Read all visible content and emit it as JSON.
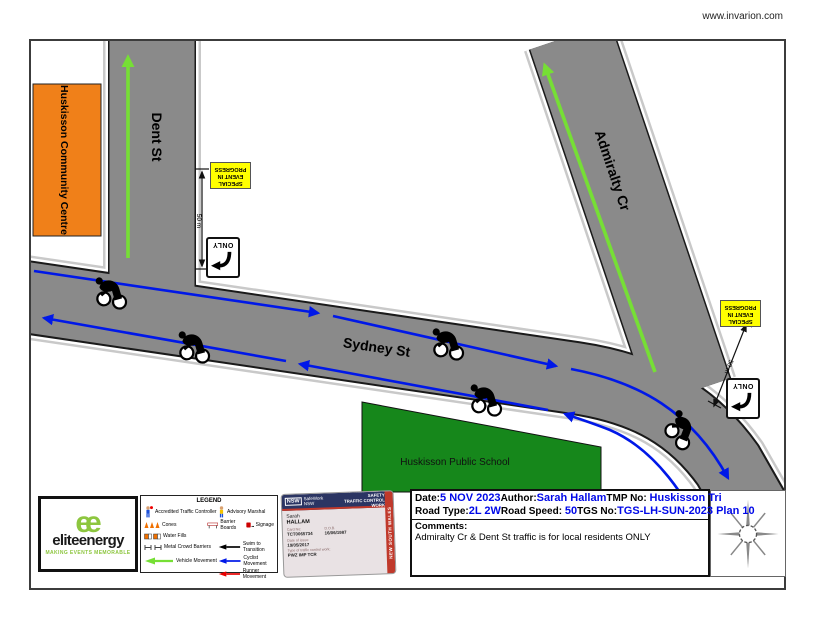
{
  "meta": {
    "watermark": "www.invarion.com"
  },
  "map": {
    "street_dent": "Dent St",
    "street_sydney": "Sydney St",
    "street_admiralty": "Admiralty Cr",
    "community_centre": "Huskisson Community Centre",
    "school": "Huskisson Public School",
    "special_event_lines": [
      "SPECIAL",
      "EVENT IN",
      "PROGRESS"
    ],
    "only_sign": "ONLY",
    "distance": "50 m"
  },
  "legend": {
    "title": "LEGEND",
    "items": {
      "traffic_controller": "Accredited Traffic Controller",
      "advisory_marshal": "Advisory Marshal",
      "cones": "Cones",
      "water_fills": "Water Fills",
      "barrier_boards": "Barrier Boards",
      "signage": "Signage",
      "crowd_barriers": "Metal Crowd Barriers",
      "swim": "Swim to Transition",
      "vehicle": "Vehicle Movement",
      "cyclist": "Cyclist Movement",
      "runner": "Runner Movement"
    }
  },
  "logo": {
    "monogram": "ee",
    "brand": "eliteenergy",
    "tagline": "MAKING EVENTS MEMORABLE"
  },
  "card": {
    "nsw": "NSW",
    "agency": "SafeWork NSW",
    "title_line1": "WORK HEALTH & SAFETY",
    "title_line2": "TRAFFIC CONTROL WORK",
    "state": "NEW SOUTH WALES",
    "first_name": "Sarah",
    "last_name": "HALLAM",
    "card_no_label": "Card No:",
    "card_no": "TCT0065734",
    "dob_label": "D.O.B.",
    "dob": "16/06/1987",
    "issue_label": "Date of issue:",
    "issue": "19/05/2017",
    "work_label": "Type of traffic control work:",
    "work": "PWZ IMP TCR"
  },
  "titleblock": {
    "date_label": "Date:",
    "date": "5 NOV 2023",
    "author_label": "Author:",
    "author": "Sarah Hallam",
    "tmp_label": "TMP No:",
    "tmp": "Huskisson Tri",
    "road_type_label": "Road Type:",
    "road_type": "2L 2W",
    "road_speed_label": "Road Speed:",
    "road_speed": "50",
    "tgs_label": "TGS No:",
    "tgs": "TGS-LH-SUN-2023 Plan 10",
    "comments_label": "Comments:",
    "comments": "Admiralty Cr & Dent St traffic is for local residents ONLY"
  },
  "colors": {
    "road_gray": "#8a8a8a",
    "sidewalk_gray": "#c9c9c9",
    "cyclist_blue": "#0018e8",
    "vehicle_green": "#76df35",
    "swim_black": "#000000",
    "runner_red": "#e80000",
    "sign_yellow": "#ffff00",
    "centre_orange": "#f08019",
    "school_green": "#16871b",
    "value_blue": "#0008e8",
    "card_navy": "#2b3563",
    "card_red": "#c0392b"
  }
}
